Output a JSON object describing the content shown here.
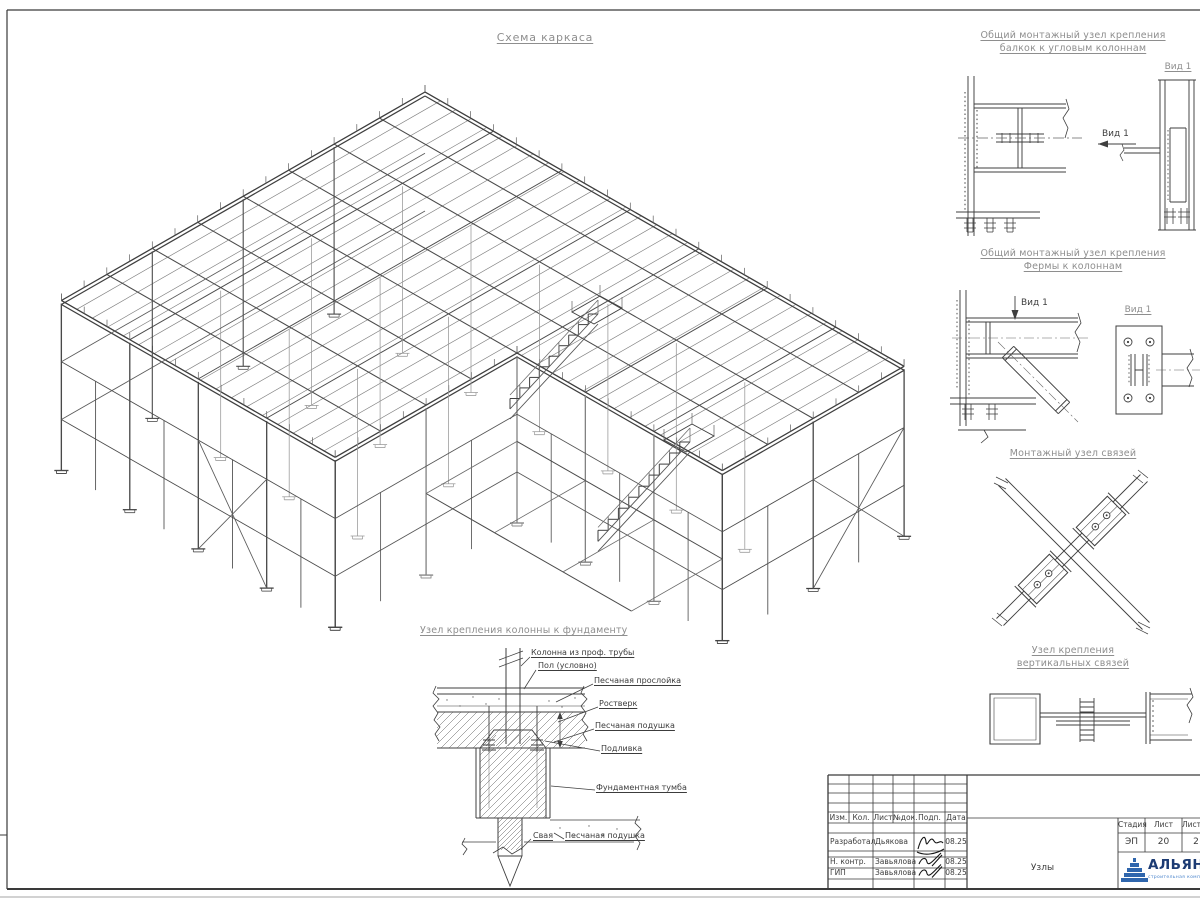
{
  "sheet_title": "Схема каркаса",
  "details": {
    "d1": {
      "title1": "Общий монтажный узел крепления",
      "title2": "балкок к угловым колоннам",
      "arrow_label": "Вид 1",
      "view_title": "Вид 1"
    },
    "d2": {
      "title1": "Общий монтажный узел крепления",
      "title2": "Фермы к колоннам",
      "arrow_label": "Вид 1",
      "view_title": "Вид 1"
    },
    "d3": {
      "title": "Монтажный узел связей"
    },
    "d4": {
      "title1": "Узел крепления",
      "title2": "вертикальных связей"
    }
  },
  "foundation": {
    "title": "Узел крепления колонны к фундаменту",
    "labels": {
      "column": "Колонна из проф. трубы",
      "floor": "Пол (условно)",
      "sand_layer": "Песчаная прослойка",
      "grillage": "Ростверк",
      "sand_cushion": "Песчаная подушка",
      "grout": "Подливка",
      "pedestal": "Фундаментная тумба",
      "pile": "Свая",
      "sand_cushion2": "Песчаная подушка"
    }
  },
  "titleblock": {
    "cols": [
      "Изм.",
      "Кол.",
      "Лист",
      "№док.",
      "Подп.",
      "Дата"
    ],
    "rows": [
      {
        "role": "Разработал",
        "name": "Дьякова",
        "date": "08.25"
      },
      {
        "role": "Н. контр.",
        "name": "Завьялова",
        "date": "08.25"
      },
      {
        "role": "ГИП",
        "name": "Завьялова",
        "date": "08.25"
      }
    ],
    "stage_label": "Стадия",
    "sheet_label": "Лист",
    "sheets_label": "Листов",
    "stage": "ЭП",
    "sheet": "20",
    "sheets": "2",
    "doc_name": "Узлы",
    "logo_text": "АЛЬЯНС",
    "logo_sub": "строительная компания"
  },
  "colors": {
    "line": "#3f3f3f",
    "title_gray": "#8e8e8e",
    "logo_blue": "#2f66ad",
    "logo_text_blue": "#1c3b73"
  }
}
